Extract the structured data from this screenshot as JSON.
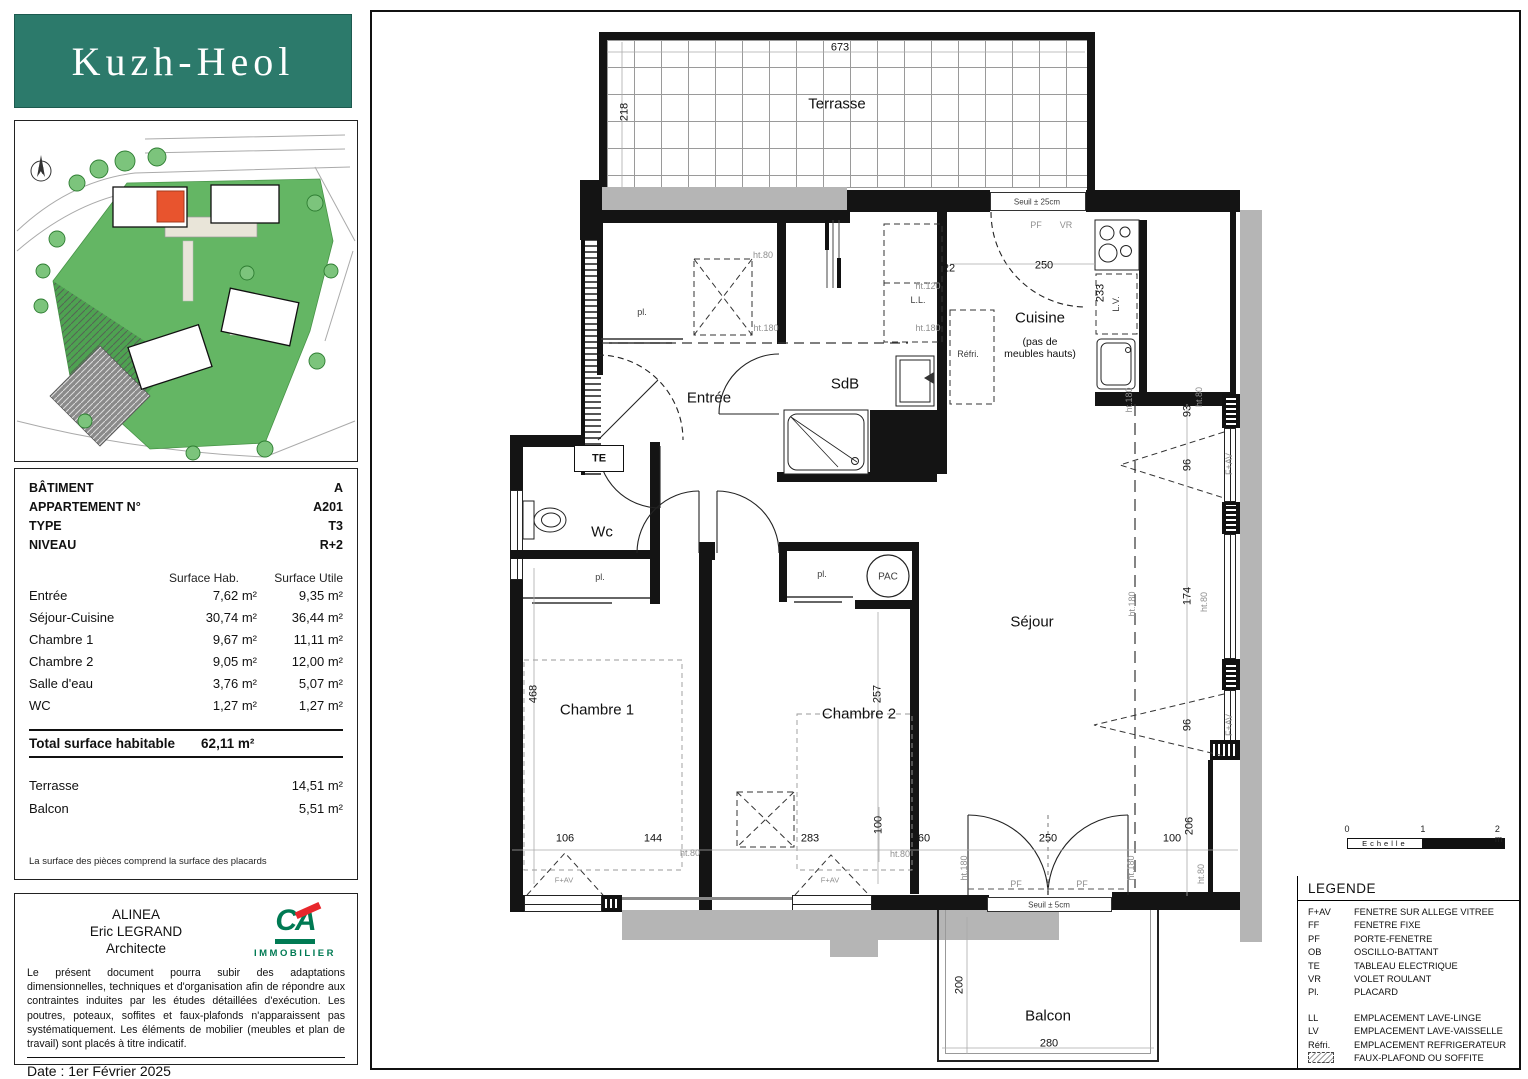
{
  "colors": {
    "accent_teal": "#2c7a6b",
    "ca_green": "#007a53",
    "ca_red": "#e8272c",
    "plan_orange": "#e8542e",
    "site_green": "#5cb35c"
  },
  "sidebar": {
    "logo_text": "Kuzh-Heol",
    "site_plan": {
      "compass": "N"
    },
    "info_rows": [
      {
        "label": "BÂTIMENT",
        "value": "A"
      },
      {
        "label": "APPARTEMENT N°",
        "value": "A201"
      },
      {
        "label": "TYPE",
        "value": "T3"
      },
      {
        "label": "NIVEAU",
        "value": "R+2"
      }
    ],
    "surfaces": {
      "col1": "Surface Hab.",
      "col2": "Surface Utile",
      "rows": [
        {
          "name": "Entrée",
          "hab": "7,62 m²",
          "utile": "9,35 m²"
        },
        {
          "name": "Séjour-Cuisine",
          "hab": "30,74 m²",
          "utile": "36,44 m²"
        },
        {
          "name": "Chambre 1",
          "hab": "9,67 m²",
          "utile": "11,11 m²"
        },
        {
          "name": "Chambre 2",
          "hab": "9,05 m²",
          "utile": "12,00 m²"
        },
        {
          "name": "Salle d'eau",
          "hab": "3,76 m²",
          "utile": "5,07 m²"
        },
        {
          "name": "WC",
          "hab": "1,27 m²",
          "utile": "1,27 m²"
        }
      ]
    },
    "total": {
      "label": "Total surface habitable",
      "value": "62,11 m²"
    },
    "extras": [
      {
        "name": "Terrasse",
        "value": "14,51 m²"
      },
      {
        "name": "Balcon",
        "value": "5,51 m²"
      }
    ],
    "footnote": "La surface des pièces comprend la surface des placards",
    "architect": {
      "lines": [
        {
          "text": "ALINEA"
        },
        {
          "text": "Eric LEGRAND"
        },
        {
          "text": "Architecte"
        }
      ],
      "logo_text": "CA",
      "logo_sub": "IMMOBILIER"
    },
    "disclaimer": "Le présent document pourra subir des adaptations dimensionnelles, techniques et d'organisation afin de répondre aux contraintes induites par les études détaillées d'exécution. Les poutres, poteaux, soffites et faux-plafonds n'apparaissent pas systématiquement. Les éléments de mobilier (meubles et plan de travail) sont placés à titre indicatif.",
    "date": "Date : 1er Février 2025"
  },
  "legend": {
    "title": "LEGENDE",
    "scale": {
      "ticks": [
        {
          "t": "0"
        },
        {
          "t": "1"
        },
        {
          "t": "2 m"
        }
      ],
      "bar_label": "Echelle"
    },
    "items": [
      {
        "abbr": "F+AV",
        "label": "FENETRE SUR ALLEGE VITREE"
      },
      {
        "abbr": "FF",
        "label": "FENETRE FIXE"
      },
      {
        "abbr": "PF",
        "label": "PORTE-FENETRE"
      },
      {
        "abbr": "OB",
        "label": "OSCILLO-BATTANT"
      },
      {
        "abbr": "TE",
        "label": "TABLEAU ELECTRIQUE"
      },
      {
        "abbr": "VR",
        "label": "VOLET ROULANT"
      },
      {
        "abbr": "Pl.",
        "label": "PLACARD"
      },
      {
        "abbr": "LL",
        "label": "EMPLACEMENT LAVE-LINGE",
        "gap": true
      },
      {
        "abbr": "LV",
        "label": "EMPLACEMENT LAVE-VAISSELLE"
      },
      {
        "abbr": "Réfri.",
        "label": "EMPLACEMENT REFRIGERATEUR"
      },
      {
        "abbr": "",
        "label": "FAUX-PLAFOND OU SOFFITE",
        "icon": true
      }
    ]
  },
  "plan": {
    "labels": [
      {
        "name": "room-terrasse",
        "text": "Terrasse",
        "x": 465,
        "y": 92,
        "kind": "room"
      },
      {
        "name": "room-entree",
        "text": "Entrée",
        "x": 337,
        "y": 386,
        "kind": "room"
      },
      {
        "name": "room-sdb",
        "text": "SdB",
        "x": 473,
        "y": 372,
        "kind": "room"
      },
      {
        "name": "room-cuisine",
        "text": "Cuisine",
        "x": 668,
        "y": 306,
        "kind": "room"
      },
      {
        "name": "room-cuisine-note",
        "text": "(pas de\nmeubles hauts)",
        "x": 668,
        "y": 336,
        "kind": "room-sub"
      },
      {
        "name": "room-wc",
        "text": "Wc",
        "x": 230,
        "y": 520,
        "kind": "room"
      },
      {
        "name": "room-chambre-1",
        "text": "Chambre 1",
        "x": 225,
        "y": 698,
        "kind": "room"
      },
      {
        "name": "room-chambre-2",
        "text": "Chambre 2",
        "x": 487,
        "y": 702,
        "kind": "room"
      },
      {
        "name": "room-sejour",
        "text": "Séjour",
        "x": 660,
        "y": 610,
        "kind": "room"
      },
      {
        "name": "room-balcon",
        "text": "Balcon",
        "x": 676,
        "y": 1004,
        "kind": "room"
      },
      {
        "name": "dim-673",
        "text": "673",
        "x": 468,
        "y": 36,
        "kind": "dim"
      },
      {
        "name": "dim-218",
        "text": "218",
        "x": 253,
        "y": 100,
        "kind": "dim",
        "rot": 1
      },
      {
        "name": "dim-22",
        "text": "22",
        "x": 577,
        "y": 257,
        "kind": "dim"
      },
      {
        "name": "dim-250-cuisine",
        "text": "250",
        "x": 672,
        "y": 254,
        "kind": "dim"
      },
      {
        "name": "dim-233",
        "text": "233",
        "x": 729,
        "y": 281,
        "kind": "dim",
        "rot": 1
      },
      {
        "name": "dim-93",
        "text": "93",
        "x": 816,
        "y": 399,
        "kind": "dim",
        "rot": 1
      },
      {
        "name": "dim-96a",
        "text": "96",
        "x": 816,
        "y": 453,
        "kind": "dim",
        "rot": 1
      },
      {
        "name": "dim-174",
        "text": "174",
        "x": 816,
        "y": 584,
        "kind": "dim",
        "rot": 1
      },
      {
        "name": "dim-96b",
        "text": "96",
        "x": 816,
        "y": 713,
        "kind": "dim",
        "rot": 1
      },
      {
        "name": "dim-206",
        "text": "206",
        "x": 818,
        "y": 814,
        "kind": "dim",
        "rot": 1
      },
      {
        "name": "dim-100-right",
        "text": "100",
        "x": 800,
        "y": 827,
        "kind": "dim"
      },
      {
        "name": "dim-468",
        "text": "468",
        "x": 162,
        "y": 682,
        "kind": "dim",
        "rot": 1
      },
      {
        "name": "dim-257",
        "text": "257",
        "x": 506,
        "y": 682,
        "kind": "dim",
        "rot": 1
      },
      {
        "name": "dim-106",
        "text": "106",
        "x": 193,
        "y": 827,
        "kind": "dim"
      },
      {
        "name": "dim-144",
        "text": "144",
        "x": 281,
        "y": 827,
        "kind": "dim"
      },
      {
        "name": "dim-283",
        "text": "283",
        "x": 438,
        "y": 827,
        "kind": "dim"
      },
      {
        "name": "dim-100-mid",
        "text": "100",
        "x": 507,
        "y": 813,
        "kind": "dim",
        "rot": 1
      },
      {
        "name": "dim-60",
        "text": "60",
        "x": 552,
        "y": 827,
        "kind": "dim"
      },
      {
        "name": "dim-250-balcon",
        "text": "250",
        "x": 676,
        "y": 827,
        "kind": "dim"
      },
      {
        "name": "dim-280",
        "text": "280",
        "x": 677,
        "y": 1032,
        "kind": "dim"
      },
      {
        "name": "dim-200",
        "text": "200",
        "x": 588,
        "y": 973,
        "kind": "dim",
        "rot": 1
      },
      {
        "name": "tag-ht80-entree",
        "text": "ht.80",
        "x": 391,
        "y": 243
      },
      {
        "name": "tag-ht180-entree",
        "text": "ht.180",
        "x": 394,
        "y": 316
      },
      {
        "name": "tag-ht120-sdb",
        "text": "ht.120",
        "x": 556,
        "y": 274
      },
      {
        "name": "tag-ht180-sdb",
        "text": "ht.180",
        "x": 556,
        "y": 316
      },
      {
        "name": "tag-ll",
        "text": "L.L.",
        "x": 546,
        "y": 288,
        "kind": "tagd"
      },
      {
        "name": "tag-refri",
        "text": "Réfri.",
        "x": 596,
        "y": 342,
        "kind": "tagd"
      },
      {
        "name": "tag-ht180-cuisine",
        "text": "ht.180",
        "x": 757,
        "y": 388,
        "rot": 1
      },
      {
        "name": "tag-ht80-cuisine",
        "text": "ht.80",
        "x": 827,
        "y": 385,
        "rot": 1
      },
      {
        "name": "tag-ht180-sejour",
        "text": "ht.180",
        "x": 760,
        "y": 592,
        "rot": 1
      },
      {
        "name": "tag-ht80-sejour",
        "text": "ht.80",
        "x": 832,
        "y": 590,
        "rot": 1
      },
      {
        "name": "tag-ht180-balc1",
        "text": "ht.180",
        "x": 592,
        "y": 856,
        "rot": 1
      },
      {
        "name": "tag-ht180-balc2",
        "text": "ht.180",
        "x": 759,
        "y": 856,
        "rot": 1
      },
      {
        "name": "tag-ht80-balc",
        "text": "ht.80",
        "x": 829,
        "y": 862,
        "rot": 1
      },
      {
        "name": "tag-ht80-ch1",
        "text": "ht.80",
        "x": 318,
        "y": 841
      },
      {
        "name": "tag-ht80-ch2",
        "text": "ht.80",
        "x": 528,
        "y": 842
      },
      {
        "name": "tag-fav-win1",
        "text": "F+AV",
        "x": 857,
        "y": 452,
        "rot": 1
      },
      {
        "name": "tag-fav-win3",
        "text": "F+AV",
        "x": 857,
        "y": 713,
        "rot": 1
      },
      {
        "name": "tag-fav-ch1",
        "text": "F+AV",
        "x": 192,
        "y": 869,
        "fs": 7.5
      },
      {
        "name": "tag-fav-ch2",
        "text": "F+AV",
        "x": 458,
        "y": 869,
        "fs": 7.5
      },
      {
        "name": "tag-pf-top",
        "text": "PF",
        "x": 664,
        "y": 213
      },
      {
        "name": "tag-vr-top",
        "text": "VR",
        "x": 694,
        "y": 213
      },
      {
        "name": "tag-seuil25",
        "text": "Seuil ± 25cm",
        "x": 665,
        "y": 190,
        "kind": "tagd",
        "fs": 8
      },
      {
        "name": "tag-pf-balc1",
        "text": "PF",
        "x": 644,
        "y": 872
      },
      {
        "name": "tag-pf-balc2",
        "text": "PF",
        "x": 710,
        "y": 872
      },
      {
        "name": "tag-seuil5",
        "text": "Seuil ± 5cm",
        "x": 677,
        "y": 893,
        "kind": "tagd",
        "fs": 8
      },
      {
        "name": "tag-pl-entree",
        "text": "pl.",
        "x": 270,
        "y": 300,
        "kind": "tagd"
      },
      {
        "name": "tag-pl-ch1",
        "text": "pl.",
        "x": 228,
        "y": 565,
        "kind": "tagd"
      },
      {
        "name": "tag-pl-ch2",
        "text": "pl.",
        "x": 450,
        "y": 562,
        "kind": "tagd"
      },
      {
        "name": "tag-pac",
        "text": "PAC",
        "x": 516,
        "y": 565,
        "kind": "tagd",
        "fs": 10
      },
      {
        "name": "tag-te",
        "text": "TE",
        "x": 227,
        "y": 447,
        "kind": "tagb",
        "fs": 11
      },
      {
        "name": "tag-lv",
        "text": "L.V.",
        "x": 744,
        "y": 292,
        "kind": "tagd",
        "rot": 1,
        "fs": 9
      }
    ]
  }
}
